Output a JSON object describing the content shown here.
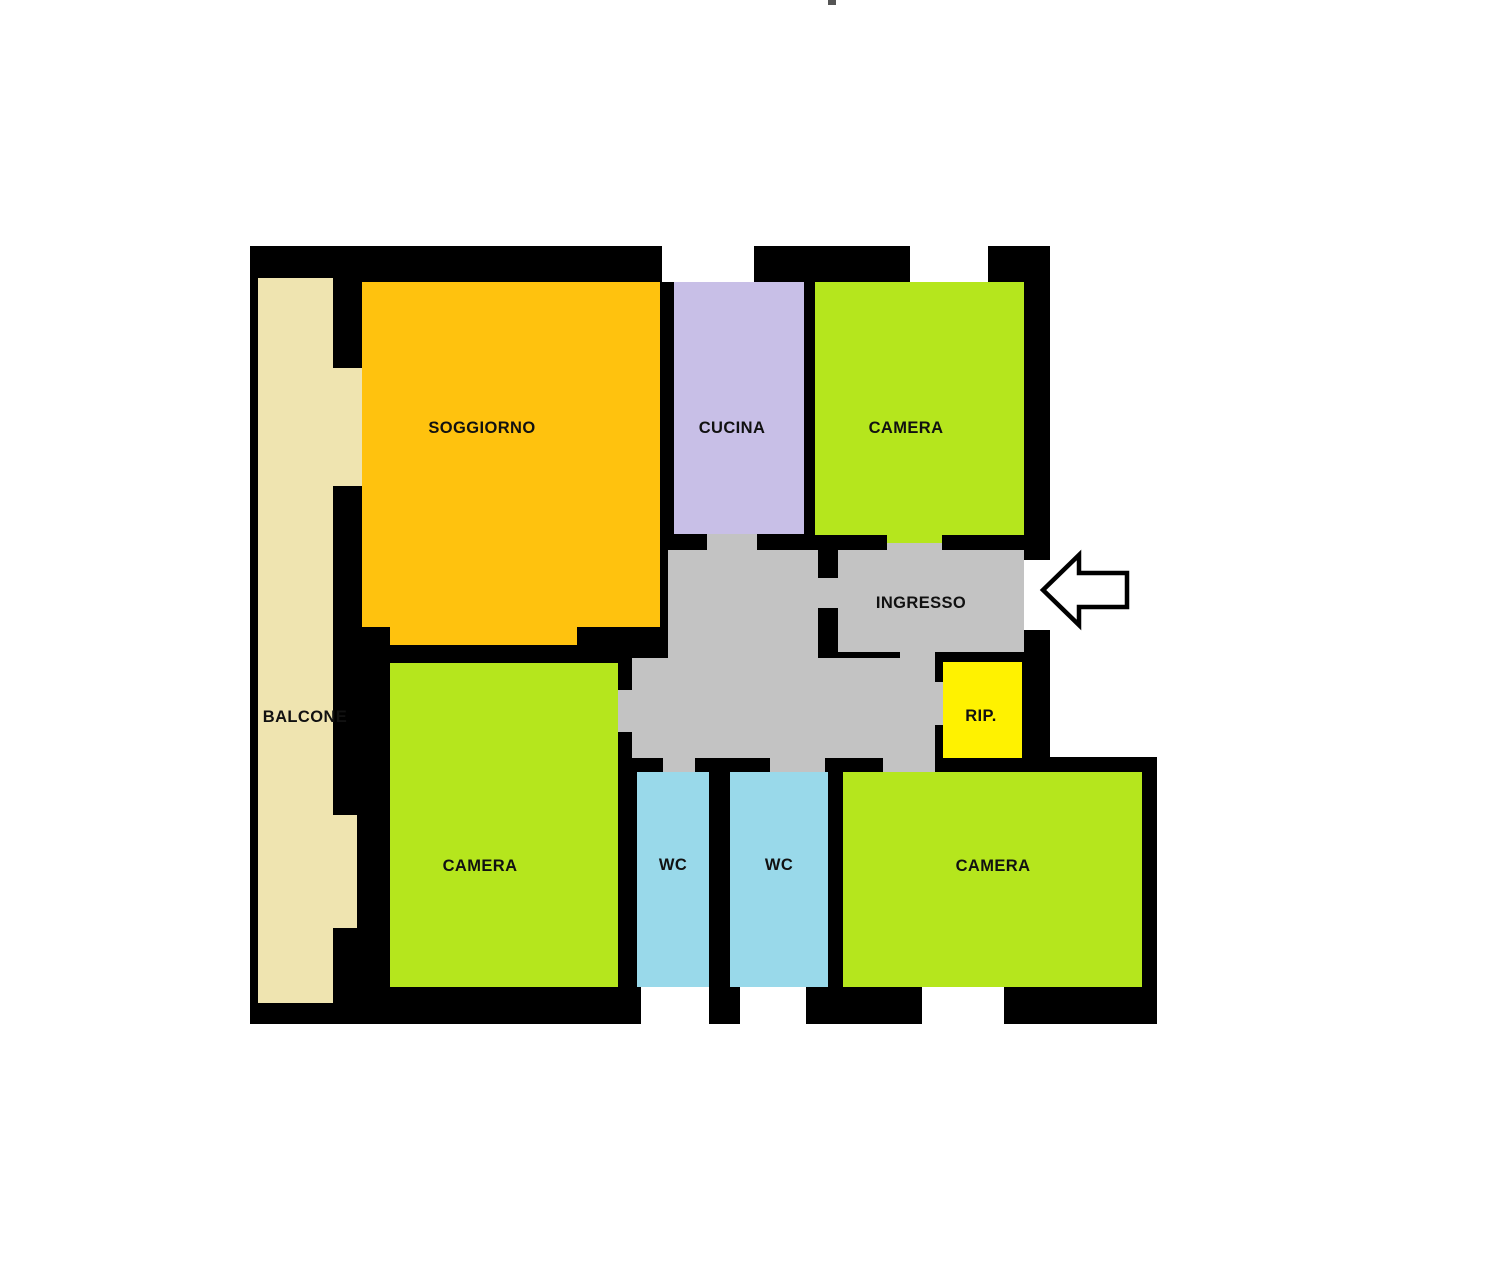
{
  "title": "apartment-floor-plan",
  "colors": {
    "background": "#ffffff",
    "wall": "#000000",
    "text": "#111111",
    "arrow_fill": "#ffffff",
    "arrow_outline": "#000000",
    "stray_mark": "#555555"
  },
  "rooms": {
    "balcone": {
      "label": "BALCONE",
      "color": "#EFE4B0"
    },
    "soggiorno": {
      "label": "SOGGIORNO",
      "color": "#FFC20E"
    },
    "cucina": {
      "label": "CUCINA",
      "color": "#C8BFE7"
    },
    "camera_nord": {
      "label": "CAMERA",
      "color": "#B5E61D"
    },
    "ingresso": {
      "label": "INGRESSO",
      "color": "#C3C3C3"
    },
    "ripostiglio": {
      "label": "RIP.",
      "color": "#FFF200"
    },
    "camera_ovest": {
      "label": "CAMERA",
      "color": "#B5E61D"
    },
    "wc_sinistro": {
      "label": "WC",
      "color": "#99D9EA"
    },
    "wc_destro": {
      "label": "WC",
      "color": "#99D9EA"
    },
    "camera_sud": {
      "label": "CAMERA",
      "color": "#B5E61D"
    },
    "disimpegno": {
      "label": "",
      "color": "#C3C3C3"
    }
  },
  "entrance": {
    "direction": "left"
  }
}
